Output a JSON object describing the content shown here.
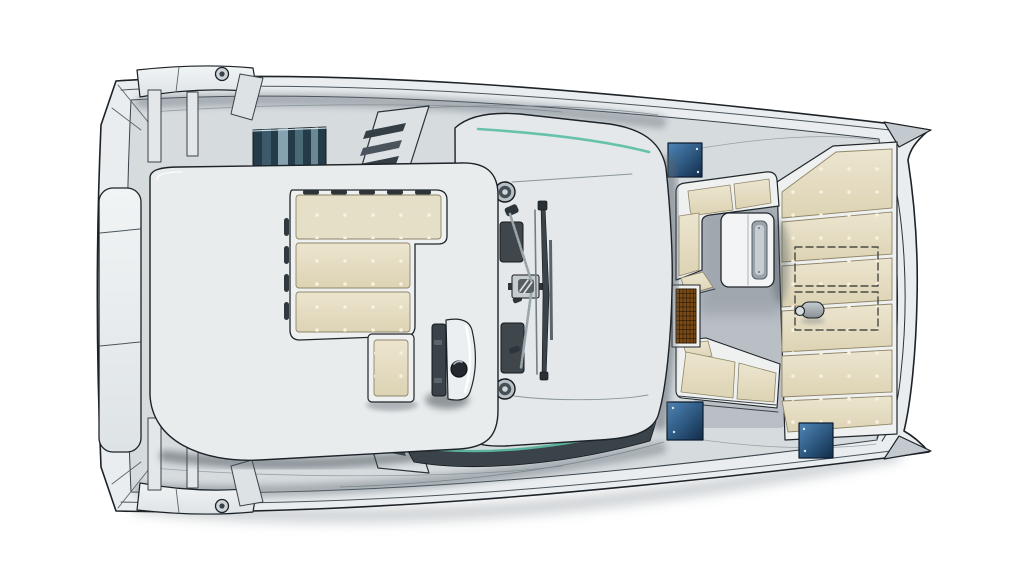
{
  "meta": {
    "title": "Catamaran deck plan - top view",
    "type": "boat-deck-plan-illustration",
    "view": "top-down",
    "canvas": {
      "width": 1024,
      "height": 580
    },
    "background": "#ffffff"
  },
  "palette": {
    "outline": "#1c2227",
    "hull_rim": "#e9edef",
    "deck": "#d6dbde",
    "coachroof": "#e4e8ea",
    "platform": "#e9eced",
    "floor": "#b9bfc5",
    "cushion": "#e6dfc8",
    "cushion_dot": "#f6f2df",
    "cushion_edge": "#8f8569",
    "cushion_frame": "#eff1f0",
    "hatch_blue_light": "#4f86b8",
    "hatch_blue_dark": "#122c49",
    "window_slat_dark": "#24404f",
    "window_slat_light": "#86a2b1",
    "teal_accent": "#5fc0a6",
    "grating_amber": "#7c4b15",
    "grating_line": "#33200a",
    "hardware_dark": "#3a4349",
    "hardware_mid": "#aab2b8",
    "table_top": "#f2f4f5",
    "table_inset": "#9aa3a9",
    "shadow": "#5a646c"
  },
  "components": {
    "hull": {
      "name": "catamaran twin hull deck",
      "bow_tips": 2,
      "rub_rail_lines": 2
    },
    "transom_platform": {
      "name": "side platform",
      "seams": 2
    },
    "sunpad_platform": {
      "name": "coachroof sunpad platform"
    },
    "sunpads": {
      "main_shape": "L",
      "rows": 3,
      "small_pads": 1,
      "dot_grid": true,
      "rail_slots": 5
    },
    "helm_console": {
      "screens": 1,
      "knobs": 1
    },
    "rigging": {
      "winches": 2,
      "rope_clutches": 3,
      "traveler_track": 1,
      "mainsheet_block": 1
    },
    "cockpit": {
      "sofa": "L-shaped",
      "sofa_cushions": 5,
      "bench_cushions": 3,
      "table_fold_channel": 1,
      "teak_grating": 1
    },
    "aft_bench": {
      "cushion_panels": 6,
      "dashed_option_outlines": 2,
      "deck_fittings": 1
    },
    "deck_hatches": {
      "count": 3,
      "color": "dark blue"
    },
    "side_windows": {
      "count": 2,
      "style": "louvered slats"
    },
    "side_stairs": {
      "count": 2,
      "treads": 3
    },
    "mooring_cleats": {
      "count": 2
    },
    "windshield": {
      "glass_tint": "teal"
    }
  }
}
